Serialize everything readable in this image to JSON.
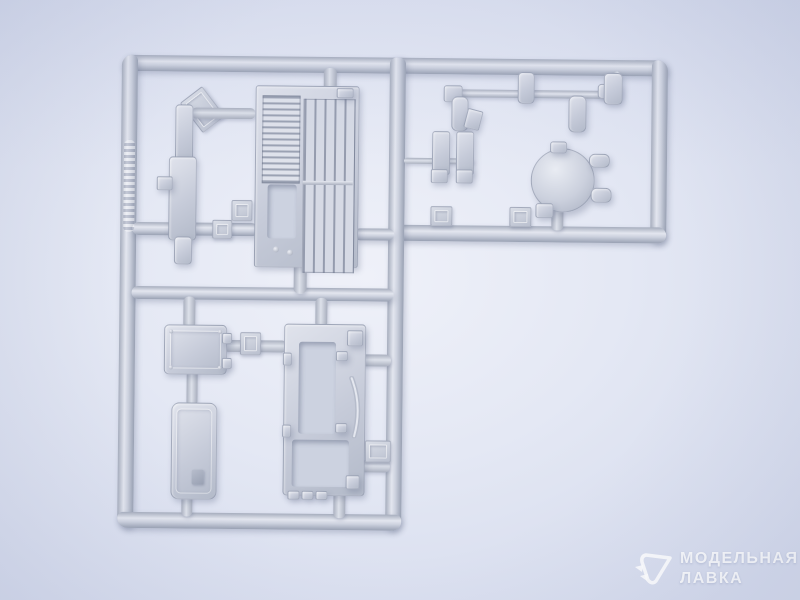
{
  "scene": {
    "type": "product-photo",
    "subject": "Injection-molded grey styrene model kit sprue (runner frame with parts)",
    "layout": "L-shaped sprue occupying the upper-left two thirds of the frame, slightly tilted clockwise"
  },
  "colors": {
    "background_center": "#eff1f9",
    "background_edge": "#d3d9ec",
    "plastic_base": "#c6cbd9",
    "plastic_highlight": "#e3e6ef",
    "plastic_shadow": "#99a1b3",
    "watermark_text": "#ffffff"
  },
  "watermark": {
    "logo": "cursor-triangle-logo",
    "line1": "МОДЕЛЬНАЯ",
    "line2": "ЛАВКА"
  },
  "sprue": {
    "frame": "rounded rectangular runner rails forming an L",
    "embossed_rail_marking": "illegible raised manufacturer lettering on left rail",
    "corner_label_tag": "small diagonal tag with embossed sprue letter near top-left corner",
    "parts": [
      {
        "name": "fender-strip-part",
        "desc": "long narrow stepped strip, upper left"
      },
      {
        "name": "engine-grille-panel",
        "desc": "panel with horizontal louvres, tall vertical-bar grate and rectangular opening"
      },
      {
        "name": "access-hatch-panel",
        "desc": "small rectangular hatch with corner bolts and edge hinges"
      },
      {
        "name": "long-hatch-panel",
        "desc": "elongated rounded rectangular panel with latch detail"
      },
      {
        "name": "frame-panel-with-openings",
        "desc": "rectangular frame panel with two cutouts and small clips"
      },
      {
        "name": "curved-strip-part",
        "desc": "thin bowed strip beside frame panel"
      },
      {
        "name": "round-hatch-dome",
        "desc": "circular dome hatch with hinge pegs and latch"
      },
      {
        "name": "thin-rod-part",
        "desc": "long thin rod across upper right section"
      },
      {
        "name": "small-cylinder-parts",
        "desc": "four small cylindrical fittings hanging from rails"
      },
      {
        "name": "bracket-pair-parts",
        "desc": "two small brackets joined by a thin bar"
      },
      {
        "name": "number-tags",
        "desc": "small embossed part-number tabs on runners"
      }
    ]
  }
}
